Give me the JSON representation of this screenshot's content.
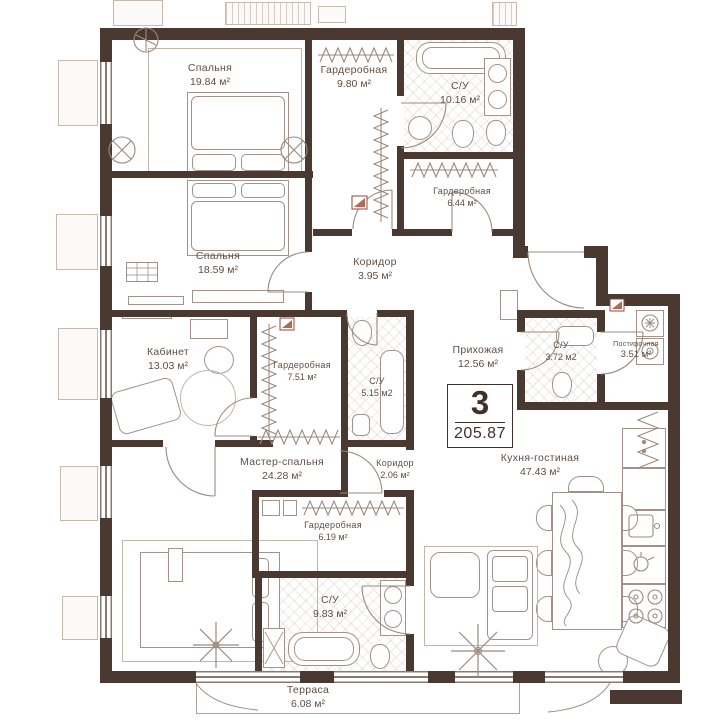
{
  "plan": {
    "info_box": {
      "number": "3",
      "total_area": "205.87"
    },
    "rooms": [
      {
        "name": "Спальня",
        "area": "19.84 м²"
      },
      {
        "name": "Гардеробная",
        "area": "9.80 м²"
      },
      {
        "name": "С/У",
        "area": "10.16 м²"
      },
      {
        "name": "Гардеробная",
        "area": "6.44 м²"
      },
      {
        "name": "Спальня",
        "area": "18.59 м²"
      },
      {
        "name": "Коридор",
        "area": "3.95 м²"
      },
      {
        "name": "Кабинет",
        "area": "13.03 м²"
      },
      {
        "name": "Гардеробная",
        "area": "7.51 м²"
      },
      {
        "name": "С/У",
        "area": "5.15 м2"
      },
      {
        "name": "Прихожая",
        "area": "12.56 м²"
      },
      {
        "name": "С/У",
        "area": "3.72 м2"
      },
      {
        "name": "Постирочная",
        "area": "3.51 м²"
      },
      {
        "name": "Мастер-спальня",
        "area": "24.28 м²"
      },
      {
        "name": "Коридор",
        "area": "2.06 м²"
      },
      {
        "name": "Кухня-гостиная",
        "area": "47.43 м²"
      },
      {
        "name": "Гардеробная",
        "area": "6.19 м²"
      },
      {
        "name": "С/У",
        "area": "9.83 м²"
      },
      {
        "name": "Терраса",
        "area": "6.08 м²"
      }
    ],
    "colors": {
      "wall": "#4a3930",
      "line": "#9b8a7d",
      "label": "#5f4f44",
      "hatch": "#e8d9cf"
    }
  }
}
